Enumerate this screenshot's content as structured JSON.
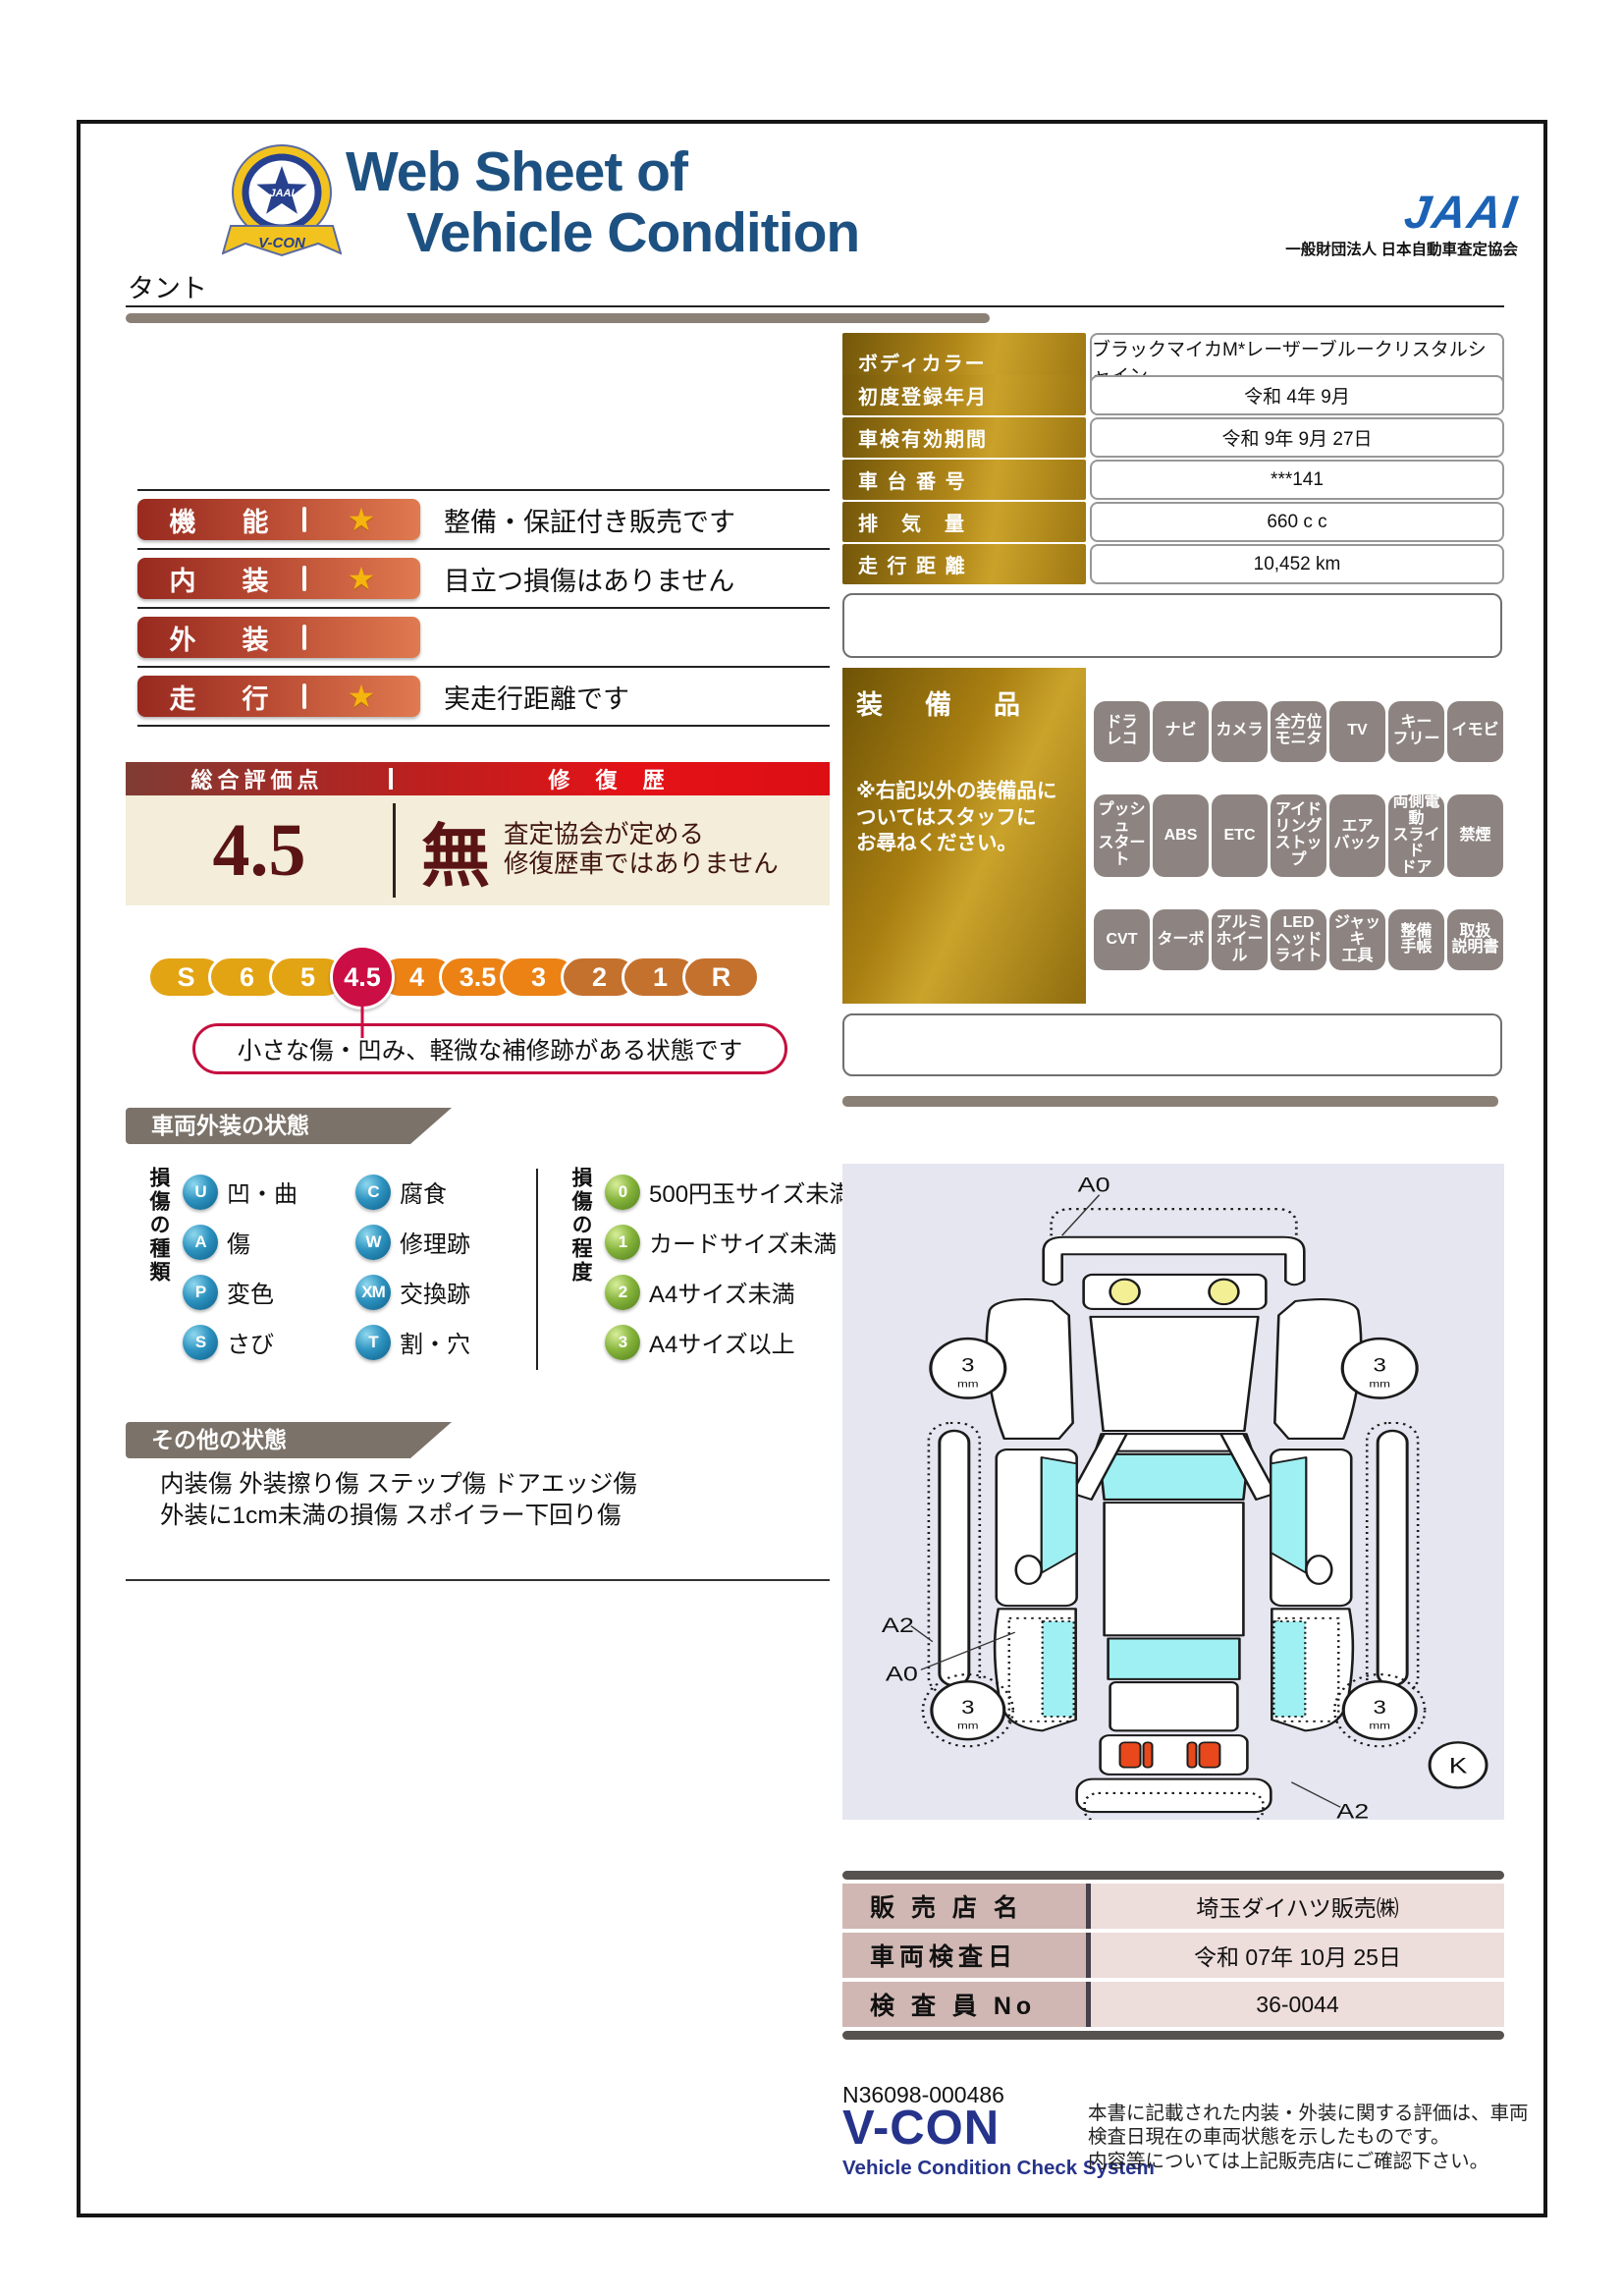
{
  "header": {
    "title_line1": "Web Sheet of",
    "title_line2": "Vehicle Condition",
    "emblem_text": "V-CON",
    "emblem_star_text": "JAAI",
    "jaai_logo": "JAAI",
    "jaai_org": "一般財団法人 日本自動車査定協会"
  },
  "vehicle_name": "タント",
  "ratings": {
    "rows": [
      {
        "label": "機　能",
        "star": true,
        "note": "整備・保証付き販売です"
      },
      {
        "label": "内　装",
        "star": true,
        "note": "目立つ損傷はありません"
      },
      {
        "label": "外　装",
        "star": false,
        "note": ""
      },
      {
        "label": "走　行",
        "star": true,
        "note": "実走行距離です"
      }
    ],
    "star_glyph": "★"
  },
  "vehicle_info": {
    "rows": [
      {
        "label": "ボディカラー",
        "value": "ブラックマイカM*レーザーブルークリスタルシャイン"
      },
      {
        "label": "初度登録年月",
        "value": "令和 4年 9月"
      },
      {
        "label": "車検有効期間",
        "value": "令和 9年 9月 27日"
      },
      {
        "label": "車 台 番 号",
        "value": "***141"
      },
      {
        "label": "排　気　量",
        "value": "660 c c"
      },
      {
        "label": "走 行 距 離",
        "value": "10,452 km"
      }
    ]
  },
  "overall": {
    "score_header": "総合評価点",
    "repair_header": "修 復 歴",
    "score": "4.5",
    "repair_status": "無",
    "repair_note1": "査定協会が定める",
    "repair_note2": "修復歴車ではありません"
  },
  "scale": {
    "segments": [
      {
        "label": "S",
        "color": "#e3a414",
        "selected": false
      },
      {
        "label": "6",
        "color": "#e3a414",
        "selected": false
      },
      {
        "label": "5",
        "color": "#e3a414",
        "selected": false
      },
      {
        "label": "4.5",
        "color": "#cb0e44",
        "selected": true
      },
      {
        "label": "4",
        "color": "#ec8214",
        "selected": false
      },
      {
        "label": "3.5",
        "color": "#ec8214",
        "selected": false
      },
      {
        "label": "3",
        "color": "#ec8214",
        "selected": false
      },
      {
        "label": "2",
        "color": "#c4712e",
        "selected": false
      },
      {
        "label": "1",
        "color": "#c4712e",
        "selected": false
      },
      {
        "label": "R",
        "color": "#c4712e",
        "selected": false
      }
    ],
    "callout": "小さな傷・凹み、軽微な補修跡がある状態です"
  },
  "exterior": {
    "title": "車両外装の状態",
    "types_label": "損傷の種類",
    "types": [
      {
        "code": "U",
        "label": "凹・曲"
      },
      {
        "code": "A",
        "label": "傷"
      },
      {
        "code": "P",
        "label": "変色"
      },
      {
        "code": "S",
        "label": "さび"
      },
      {
        "code": "C",
        "label": "腐食"
      },
      {
        "code": "W",
        "label": "修理跡"
      },
      {
        "code": "XM",
        "label": "交換跡"
      },
      {
        "code": "T",
        "label": "割・穴"
      }
    ],
    "levels_label": "損傷の程度",
    "levels": [
      {
        "code": "0",
        "label": "500円玉サイズ未満"
      },
      {
        "code": "1",
        "label": "カードサイズ未満"
      },
      {
        "code": "2",
        "label": "A4サイズ未満"
      },
      {
        "code": "3",
        "label": "A4サイズ以上"
      }
    ]
  },
  "other": {
    "title": "その他の状態",
    "line1": "内装傷 外装擦り傷 ステップ傷 ドアエッジ傷",
    "line2": "外装に1cm未満の損傷 スポイラー下回り傷"
  },
  "equipment": {
    "title": "装　備　品",
    "note": "※右記以外の装備品に\nついてはスタッフに\nお尋ねください。",
    "rows": [
      [
        "ドラ\nレコ",
        "ナビ",
        "カメラ",
        "全方位\nモニタ",
        "TV",
        "キー\nフリー",
        "イモビ"
      ],
      [
        "プッシュ\nスタート",
        "ABS",
        "ETC",
        "アイド\nリング\nストップ",
        "エア\nバック",
        "両側電動\nスライド\nドア",
        "禁煙"
      ],
      [
        "CVT",
        "ターボ",
        "アルミ\nホイール",
        "LED\nヘッド\nライト",
        "ジャッキ\n工具",
        "整備\n手帳",
        "取扱\n説明書"
      ]
    ]
  },
  "diagram": {
    "front_label": "A0",
    "door_label": "A2",
    "rocker_label": "A0",
    "rear_label": "A2",
    "corner_mark": "K",
    "tire_value": "3",
    "tire_unit": "mm"
  },
  "dealer": {
    "rows": [
      {
        "label": "販 売 店 名",
        "value": "埼玉ダイハツ販売㈱"
      },
      {
        "label": "車両検査日",
        "value": "令和 07年 10月 25日"
      },
      {
        "label": "検 査 員 No",
        "value": "36-0044"
      }
    ]
  },
  "footer": {
    "doc_no": "N36098-000486",
    "vcon": "V-CON",
    "vcon_sub": "Vehicle Condition Check System",
    "note1": "本書に記載された内装・外装に関する評価は、車両",
    "note2": "検査日現在の車両状態を示したものです。",
    "note3": "内容等については上記販売店にご確認下さい。"
  }
}
